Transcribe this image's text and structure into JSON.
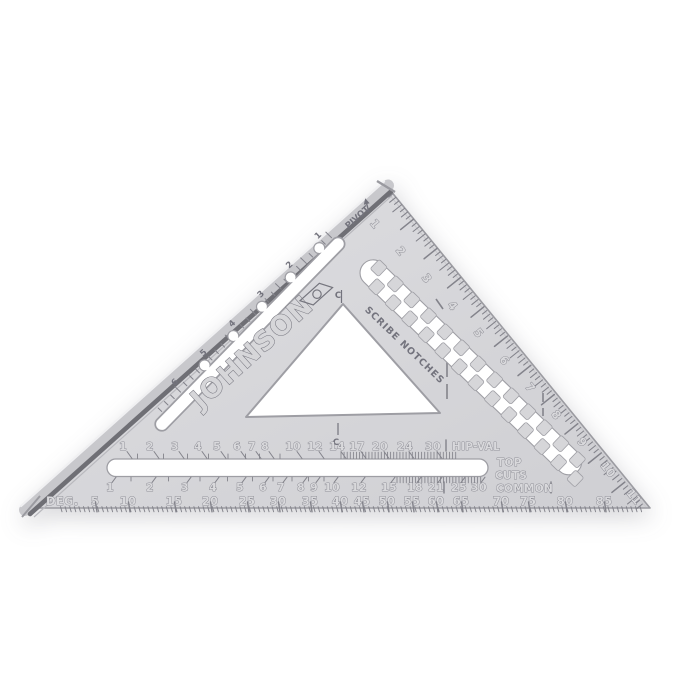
{
  "page": {
    "background": "#ffffff"
  },
  "square": {
    "brand": "JOHNSON",
    "body_color": "#d6d6d9",
    "fence_dark": "#6f6f75",
    "engrave_color": "#7d7d86",
    "labels": {
      "pivot": "PIVOT",
      "scribe_notches": "SCRIBE NOTCHES",
      "hip_val": "HIP-VAL",
      "top_cuts_line1": "TOP",
      "top_cuts_line2": "CUTS",
      "common": "COMMON",
      "deg": "DEG.",
      "centerline_letter": "C"
    },
    "scales": {
      "edge_inches": {
        "unit": "inches",
        "values": [
          "1",
          "2",
          "3",
          "4",
          "5",
          "6",
          "7",
          "8",
          "9",
          "10",
          "11"
        ]
      },
      "hip_val": {
        "values": [
          "1",
          "2",
          "3",
          "4",
          "5",
          "6",
          "7",
          "8",
          "10",
          "12",
          "14",
          "17",
          "20",
          "24",
          "30"
        ],
        "x": [
          123,
          150,
          175,
          198,
          217,
          237,
          252,
          265,
          293,
          315,
          337,
          357,
          380,
          405,
          433
        ]
      },
      "common": {
        "values": [
          "1",
          "2",
          "3",
          "4",
          "5",
          "6",
          "7",
          "8",
          "9",
          "10",
          "12",
          "15",
          "18",
          "21",
          "25",
          "30"
        ],
        "x": [
          110,
          150,
          185,
          213,
          240,
          263,
          281,
          301,
          314,
          332,
          359,
          389,
          415,
          436,
          459,
          479
        ]
      },
      "degrees": {
        "values": [
          "5",
          "10",
          "15",
          "20",
          "25",
          "30",
          "35",
          "40",
          "45",
          "50",
          "55",
          "60",
          "65",
          "70",
          "75",
          "80",
          "85"
        ],
        "x": [
          95,
          128,
          174,
          210,
          247,
          278,
          310,
          340,
          362,
          387,
          412,
          436,
          461,
          501,
          528,
          565,
          604
        ]
      },
      "fence_scribe": {
        "values": [
          "1",
          "2",
          "3",
          "4",
          "5",
          "6"
        ]
      }
    }
  }
}
